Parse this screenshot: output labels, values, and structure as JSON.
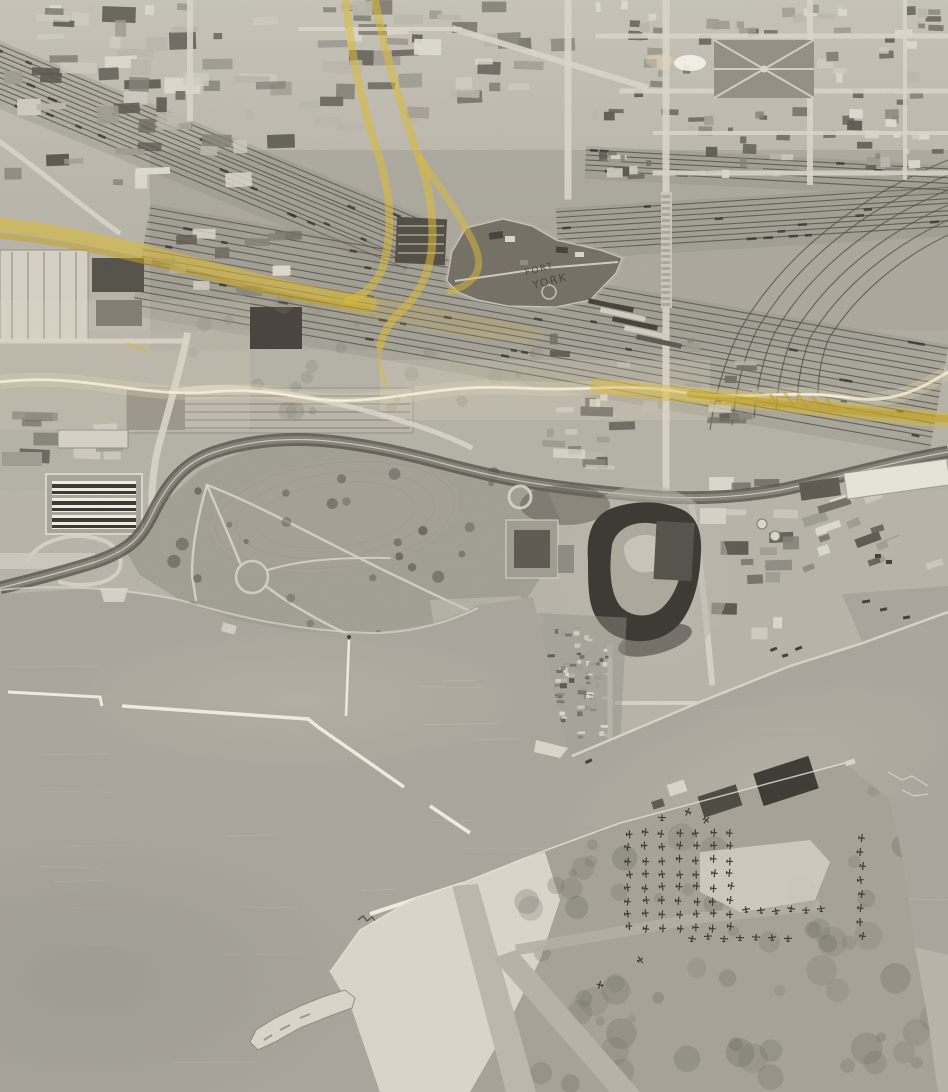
{
  "image": {
    "alt": "Vertical black-and-white aerial photograph of a lakeside city: rail corridor and yards across the top, a star fort in the middle, a curving waterfront park, a baseball stadium, harbour with breakwaters, and an island airfield with parked aircraft; yellow crayon route lines and a pale crease are drawn across the photo"
  },
  "annotations": {
    "handwritten_label": {
      "lines": [
        "FORT",
        "YORK"
      ]
    },
    "marker": {
      "color": "#d9b92f",
      "style": "yellow crayon route lines"
    }
  },
  "palette": {
    "paper": "#b5b1a8",
    "cityLight": "#c8c4bb",
    "scrub": "#9d9990",
    "grass": "#9e9a90",
    "grassDark": "#84807a",
    "road": "#d7d3ca",
    "rail": "#454139",
    "railBed": "#8d8981",
    "water": "#a6a29a",
    "waterDark": "#908d86",
    "waterLight": "#b4b0a8",
    "sand": "#d8d4c9",
    "islandVeg": "#6b675f",
    "stadiumDark": "#33302b",
    "fort": "#6e6a60",
    "buildingDark": "#54504a",
    "buildingLight": "#e2dfd6",
    "yellow": "#d9b92f",
    "yellowDeep": "#c19a12",
    "cream": "#ead9ac",
    "crease": "#f2ecda",
    "ink": "#3c3831",
    "white": "#f5f3ec"
  },
  "procedural": {
    "seed": 11,
    "shades": [
      "#56524b",
      "#6b675f",
      "#807c74",
      "#9b978f",
      "#b8b4ab",
      "#cdc9c0",
      "#ddd9d0"
    ],
    "mosaics": [
      {
        "name": "city-top-left",
        "x": 2,
        "y": 2,
        "w": 294,
        "h": 200,
        "n": 62,
        "wMin": 8,
        "wMax": 38,
        "hMin": 5,
        "hMax": 18
      },
      {
        "name": "city-top-center",
        "x": 298,
        "y": 0,
        "w": 290,
        "h": 130,
        "n": 46,
        "wMin": 8,
        "wMax": 30,
        "hMin": 5,
        "hMax": 16
      },
      {
        "name": "city-top-right",
        "x": 592,
        "y": 0,
        "w": 354,
        "h": 180,
        "n": 118,
        "wMin": 4,
        "wMax": 18,
        "hMin": 4,
        "hMax": 10,
        "avoid": [
          714,
          38,
          102,
          62
        ]
      },
      {
        "name": "warehouses-west",
        "x": 540,
        "y": 332,
        "w": 118,
        "h": 140,
        "n": 20,
        "wMin": 6,
        "wMax": 34,
        "hMin": 4,
        "hMax": 12
      },
      {
        "name": "warehouses-east",
        "x": 676,
        "y": 336,
        "w": 92,
        "h": 94,
        "n": 13,
        "wMin": 6,
        "wMax": 26,
        "hMin": 4,
        "hMax": 10
      },
      {
        "name": "stadium-east-blocks",
        "x": 700,
        "y": 472,
        "w": 100,
        "h": 172,
        "n": 18,
        "wMin": 8,
        "wMax": 28,
        "hMin": 5,
        "hMax": 14
      },
      {
        "name": "wharf-sheds",
        "x": 798,
        "y": 492,
        "w": 148,
        "h": 90,
        "n": 18,
        "wMin": 10,
        "wMax": 34,
        "hMin": 5,
        "hMax": 10,
        "rot": -20
      },
      {
        "name": "factory-left-mid",
        "x": 0,
        "y": 392,
        "w": 126,
        "h": 74,
        "n": 10,
        "wMin": 14,
        "wMax": 46,
        "hMin": 8,
        "hMax": 16
      },
      {
        "name": "corridor-sheds",
        "x": 148,
        "y": 200,
        "w": 178,
        "h": 98,
        "n": 11,
        "wMin": 10,
        "wMax": 30,
        "hMin": 5,
        "hMax": 12
      },
      {
        "name": "lumber-yard",
        "x": 534,
        "y": 620,
        "w": 78,
        "h": 132,
        "n": 58,
        "wMin": 3,
        "wMax": 9,
        "hMin": 2,
        "hMax": 5
      },
      {
        "name": "lumber-yard-dense",
        "x": 545,
        "y": 660,
        "w": 55,
        "h": 45,
        "n": 24,
        "wMin": 3,
        "wMax": 8,
        "hMin": 2,
        "hMax": 5
      }
    ],
    "scatters": [
      {
        "name": "park-trees",
        "x": 160,
        "y": 468,
        "w": 360,
        "h": 180,
        "n": 34,
        "rMin": 2.5,
        "rMax": 7,
        "color": "#4a4740",
        "alpha": 0.5
      },
      {
        "name": "scrub-mid",
        "x": 180,
        "y": 300,
        "w": 360,
        "h": 118,
        "n": 26,
        "rMin": 3,
        "rMax": 10,
        "color": "#7d7971",
        "alpha": 0.25
      },
      {
        "name": "island-veg",
        "x": 520,
        "y": 790,
        "w": 420,
        "h": 300,
        "n": 72,
        "rMin": 4,
        "rMax": 16,
        "color": "#6b675f",
        "alpha": 0.28,
        "clip": "islandClip"
      }
    ],
    "waterStreaks": {
      "n": 46,
      "x": 0,
      "y": 600,
      "w": 900,
      "h": 480,
      "lenMin": 30,
      "lenMax": 90,
      "alpha": 0.07
    },
    "railbands": [
      {
        "x": -8,
        "y": 42,
        "angle": 22.5,
        "len": 470,
        "tracks": 11,
        "gap": 5,
        "cars": 22
      },
      {
        "x": 150,
        "y": 208,
        "angle": 10,
        "len": 810,
        "tracks": 15,
        "gap": 7,
        "cars": 34
      },
      {
        "x": 556,
        "y": 212,
        "angle": -3.5,
        "len": 400,
        "tracks": 8,
        "gap": 5.5,
        "cars": 12
      },
      {
        "x": 586,
        "y": 150,
        "angle": 3,
        "len": 366,
        "tracks": 5,
        "gap": 5,
        "cars": 8
      }
    ],
    "aircraft": {
      "cols": {
        "xs": [
          628,
          645,
          662,
          679,
          696,
          713,
          730
        ],
        "y0": 833,
        "y1": 928,
        "step": 13.5
      },
      "rows": [
        {
          "y": 910,
          "x0": 746,
          "x1": 828,
          "step": 15
        },
        {
          "y": 938,
          "x0": 692,
          "x1": 788,
          "step": 16
        }
      ],
      "col2": {
        "x": 861,
        "y0": 838,
        "y1": 944,
        "step": 14
      },
      "extras": [
        [
          688,
          812
        ],
        [
          706,
          820
        ],
        [
          662,
          818
        ],
        [
          640,
          960
        ],
        [
          600,
          985
        ]
      ]
    }
  }
}
